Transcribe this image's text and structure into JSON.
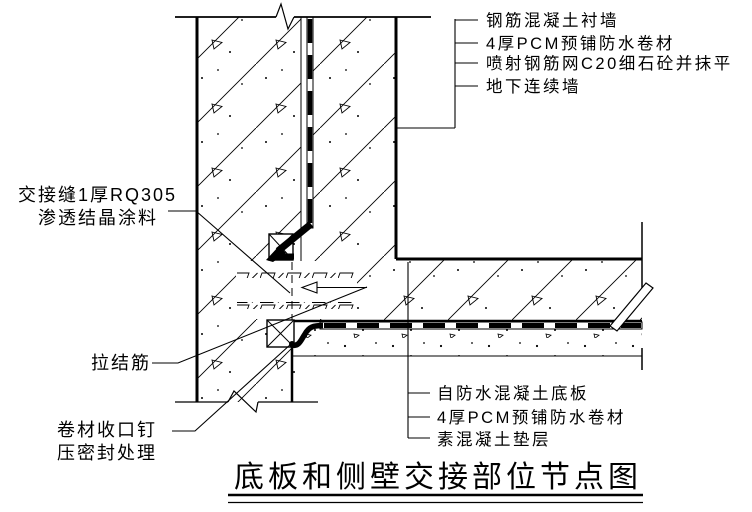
{
  "drawing": {
    "title": "底板和侧壁交接部位节点图",
    "wall_callouts": [
      "钢筋混凝土衬墙",
      "4厚PCM预铺防水卷材",
      "喷射钢筋网C20细石砼并抹平",
      "地下连续墙"
    ],
    "joint_callout": {
      "line1": "交接缝1厚RQ305",
      "line2": "渗透结晶涂料"
    },
    "tie_callout": "拉结筋",
    "seal_callout": {
      "line1": "卷材收口钉",
      "line2": "压密封处理"
    },
    "slab_callouts": [
      "自防水混凝土底板",
      "4厚PCM预铺防水卷材",
      "素混凝土垫层"
    ],
    "colors": {
      "line": "#000000",
      "background": "#ffffff"
    }
  }
}
